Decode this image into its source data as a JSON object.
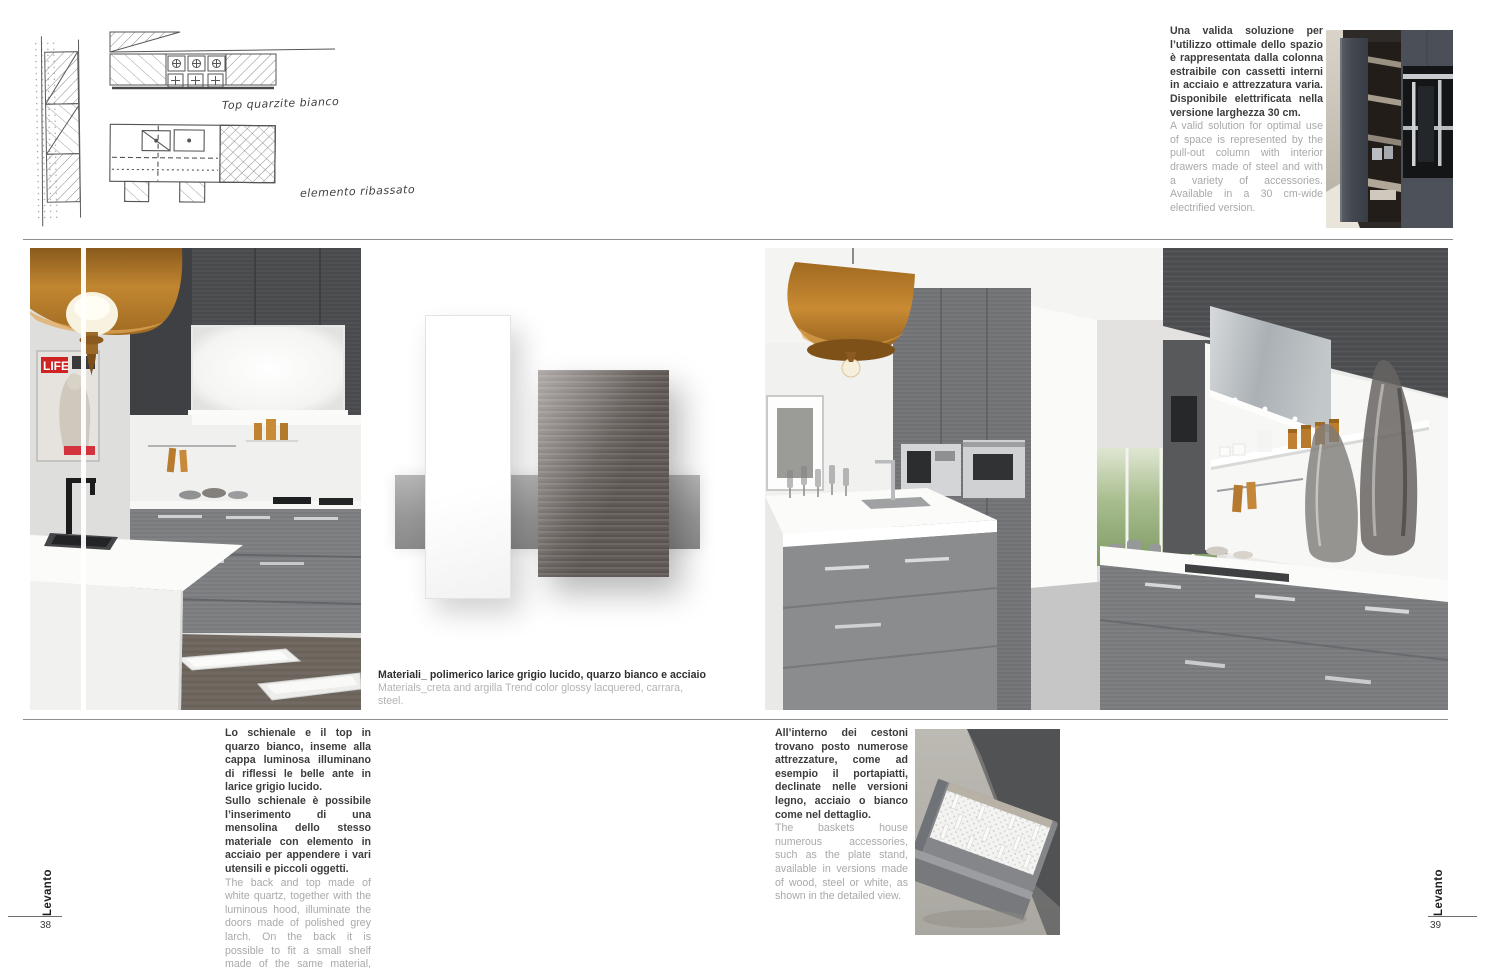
{
  "page": {
    "left_number": "38",
    "right_number": "39",
    "brand_left": "Levanto",
    "brand_right": "Levanto"
  },
  "sketch": {
    "note_top": "Top quarzite bianco",
    "note_bottom": "elemento ribassato"
  },
  "intro": {
    "it": "Una valida soluzione per l’utilizzo ottimale dello spazio è rappresentata dalla colonna estraibile con cassetti interni in acciaio e attrezzatura varia. Disponibile elettrificata nella versione larghezza 30 cm.",
    "en": "A valid solution for optimal use of space is represented by the pull-out column with interior drawers made of steel and with a variety of accessories. Available in a 30 cm-wide electrified version."
  },
  "materials_caption": {
    "it": "Materiali_ polimerico larice grigio lucido, quarzo bianco e acciaio",
    "en": "Materials_creta and argilla Trend color glossy lacquered, carrara, steel."
  },
  "body_left": {
    "it1": "Lo schienale e il top in quarzo bianco, inseme alla cappa luminosa illuminano di riflessi le belle ante in larice grigio lucido.",
    "it2": "Sullo schienale è possibile l’inserimento di una mensolina dello stesso materiale con elemento in acciaio per appendere i vari utensili e piccoli oggetti.",
    "en": "The back and top made of white quartz, together with the luminous hood, illuminate the doors made of polished grey larch. On the back it is possible to fit a small shelf made of the same material, with a steel element."
  },
  "body_right": {
    "it": "All’interno dei cestoni trovano posto numerose attrezzature, come ad esempio il portapiatti, declinate nelle versioni legno, acciaio o bianco come nel dettaglio.",
    "en": "The baskets house numerous accessories, such as the plate stand, available in versions made of wood, steel or white, as shown in the detailed view."
  },
  "poster": {
    "title": "LIFE"
  },
  "colors": {
    "accent_orange": "#b8792c",
    "cabinet_grey": "#55585b",
    "text_dark": "#3c3c3c",
    "text_light": "#a9a9a9",
    "poster_red": "#d02a2a"
  }
}
